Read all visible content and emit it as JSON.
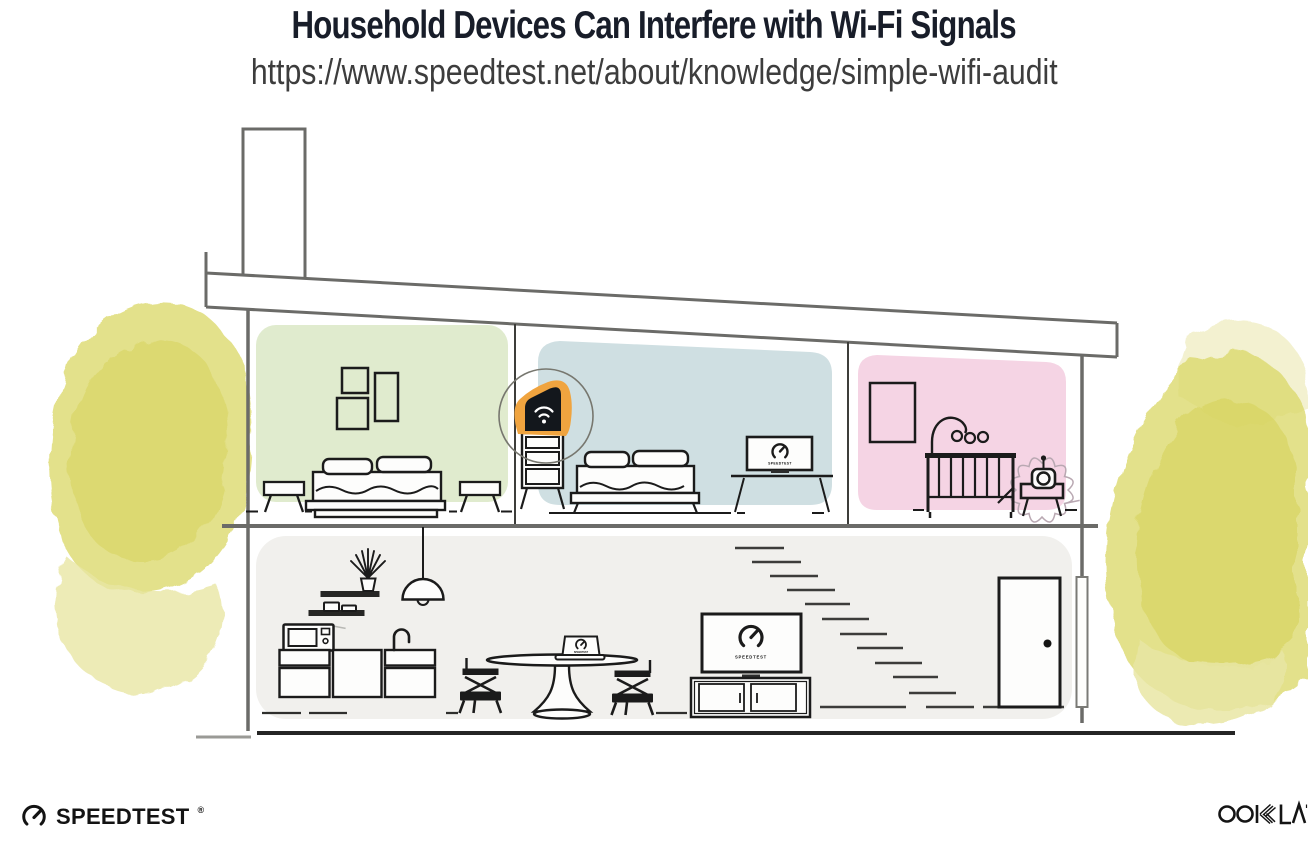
{
  "header": {
    "title": "Household Devices Can Interfere with Wi-Fi Signals",
    "url": "https://www.speedtest.net/about/knowledge/simple-wifi-audit"
  },
  "footer": {
    "speedtest": {
      "text": "SPEEDTEST",
      "reg": "®"
    },
    "ookla": {
      "text": "OOKLA"
    }
  },
  "illustration": {
    "screen_labels": {
      "bedroom_monitor": "SPEEDTEST",
      "living_room_tv": "SPEEDTEST",
      "dining_laptop": "SPEEDTEST"
    },
    "devices": [
      "wifi-router",
      "baby-monitor",
      "microwave-oven",
      "bedroom-monitor",
      "living-room-tv",
      "dining-laptop"
    ],
    "rooms": [
      "bedroom-green",
      "bedroom-blue",
      "nursery-pink",
      "kitchen-living-area"
    ],
    "colors": {
      "title_ink": "#181d29",
      "url_ink": "#3d3d3d",
      "line_gray": "#6b6b68",
      "ink": "#1b1b1b",
      "green_room": "#e0ebce",
      "blue_room": "#cfdfe2",
      "pink_room": "#f5d4e4",
      "lower_floor": "#f1f0ed",
      "foliage": "#dcd96e",
      "foliage_core": "#d5d158",
      "foliage_light": "#e9e6a4",
      "foliage_pale": "#f1eec8",
      "router_highlight": "#f0a43f"
    }
  }
}
